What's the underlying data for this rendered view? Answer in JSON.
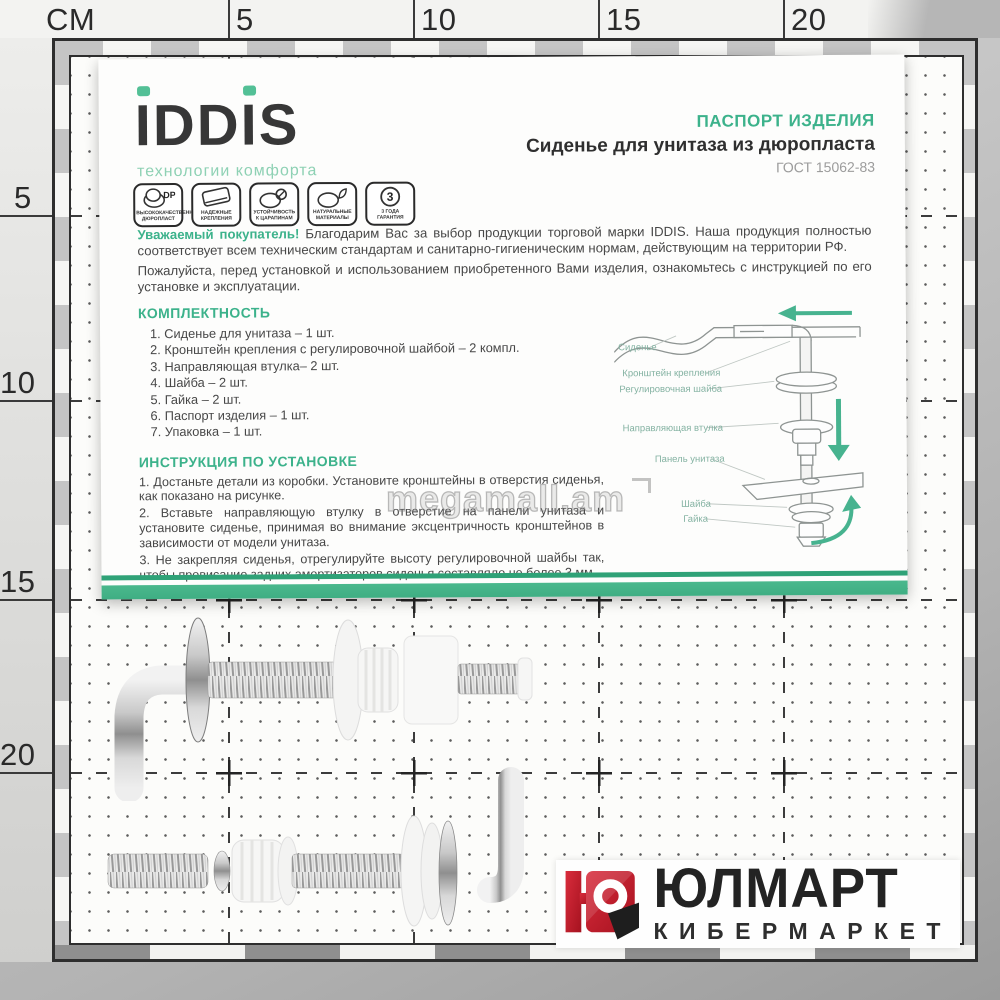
{
  "colors": {
    "accent_green": "#3cb28b",
    "band_green": "#44b489",
    "tagline_green": "#8ed1b4",
    "brand_dark": "#373737",
    "body_text": "#474747",
    "gost_gray": "#9b9b9b",
    "retailer_red": "#c1202e",
    "retailer_dark": "#242424"
  },
  "ruler": {
    "unit_label": "CM",
    "top_ticks": [
      "5",
      "10",
      "15",
      "20"
    ],
    "left_ticks": [
      "5",
      "10",
      "15",
      "20"
    ]
  },
  "watermark": {
    "text": "megamall.am"
  },
  "passport": {
    "brand": {
      "name": "IDDIS",
      "letters": [
        "I",
        "D",
        "D",
        "I",
        "S"
      ],
      "tagline": "технологии комфорта"
    },
    "badges": [
      {
        "symbol": "DP",
        "label": "высококачественный дюропласт",
        "icon": "seat-duroplast-icon"
      },
      {
        "symbol": "",
        "label": "надежные крепления",
        "icon": "seat-fastening-icon"
      },
      {
        "symbol": "",
        "label": "устойчивость к царапинам",
        "icon": "scratch-resistant-icon"
      },
      {
        "symbol": "",
        "label": "натуральные материалы",
        "icon": "eco-materials-icon"
      },
      {
        "symbol": "3",
        "label": "3 года гарантия",
        "icon": "warranty-icon"
      }
    ],
    "header": {
      "title": "ПАСПОРТ ИЗДЕЛИЯ",
      "subtitle": "Сиденье для унитаза из дюропласта",
      "standard": "ГОСТ 15062-83"
    },
    "greeting": {
      "lead": "Уважаемый покупатель!",
      "paragraph1": "Благодарим Вас за выбор продукции торговой марки IDDIS. Наша продукция полностью соответствует всем техническим стандартам и санитарно-гигиеническим нормам, действующим на территории РФ.",
      "paragraph2": "Пожалуйста, перед установкой и использованием приобретенного Вами изделия, ознакомьтесь с инструкцией по его установке и эксплуатации."
    },
    "completeness": {
      "title": "КОМПЛЕКТНОСТЬ",
      "items": [
        "1. Сиденье для унитаза – 1 шт.",
        "2. Кронштейн крепления с регулировочной шайбой – 2 компл.",
        "3. Направляющая втулка– 2 шт.",
        "4. Шайба – 2 шт.",
        "5. Гайка – 2 шт.",
        "6. Паспорт изделия – 1 шт.",
        "7. Упаковка – 1 шт."
      ]
    },
    "instructions": {
      "title": "ИНСТРУКЦИЯ ПО УСТАНОВКЕ",
      "steps": [
        "1. Достаньте детали из коробки. Установите кронштейны в отверстия сиденья, как показано на рисунке.",
        "2. Вставьте направляющую втулку в отверстие на панели унитаза и установите сиденье, принимая во внимание эксцентричность кронштейнов в зависимости от модели унитаза.",
        "3. Не закрепляя сиденья, отрегулируйте высоту регулировочной шайбы так, чтобы провисание задних амортизаторов сиденья составляло не более 3 мм."
      ]
    },
    "diagram": {
      "labels": [
        "Сиденье",
        "Кронштейн крепления",
        "Регулировочная шайба",
        "Направляющая втулка",
        "Панель унитаза",
        "Шайба",
        "Гайка"
      ]
    }
  },
  "retailer": {
    "name": "ЮЛМАРТ",
    "tagline": "КИБЕРМАРКЕТ"
  }
}
